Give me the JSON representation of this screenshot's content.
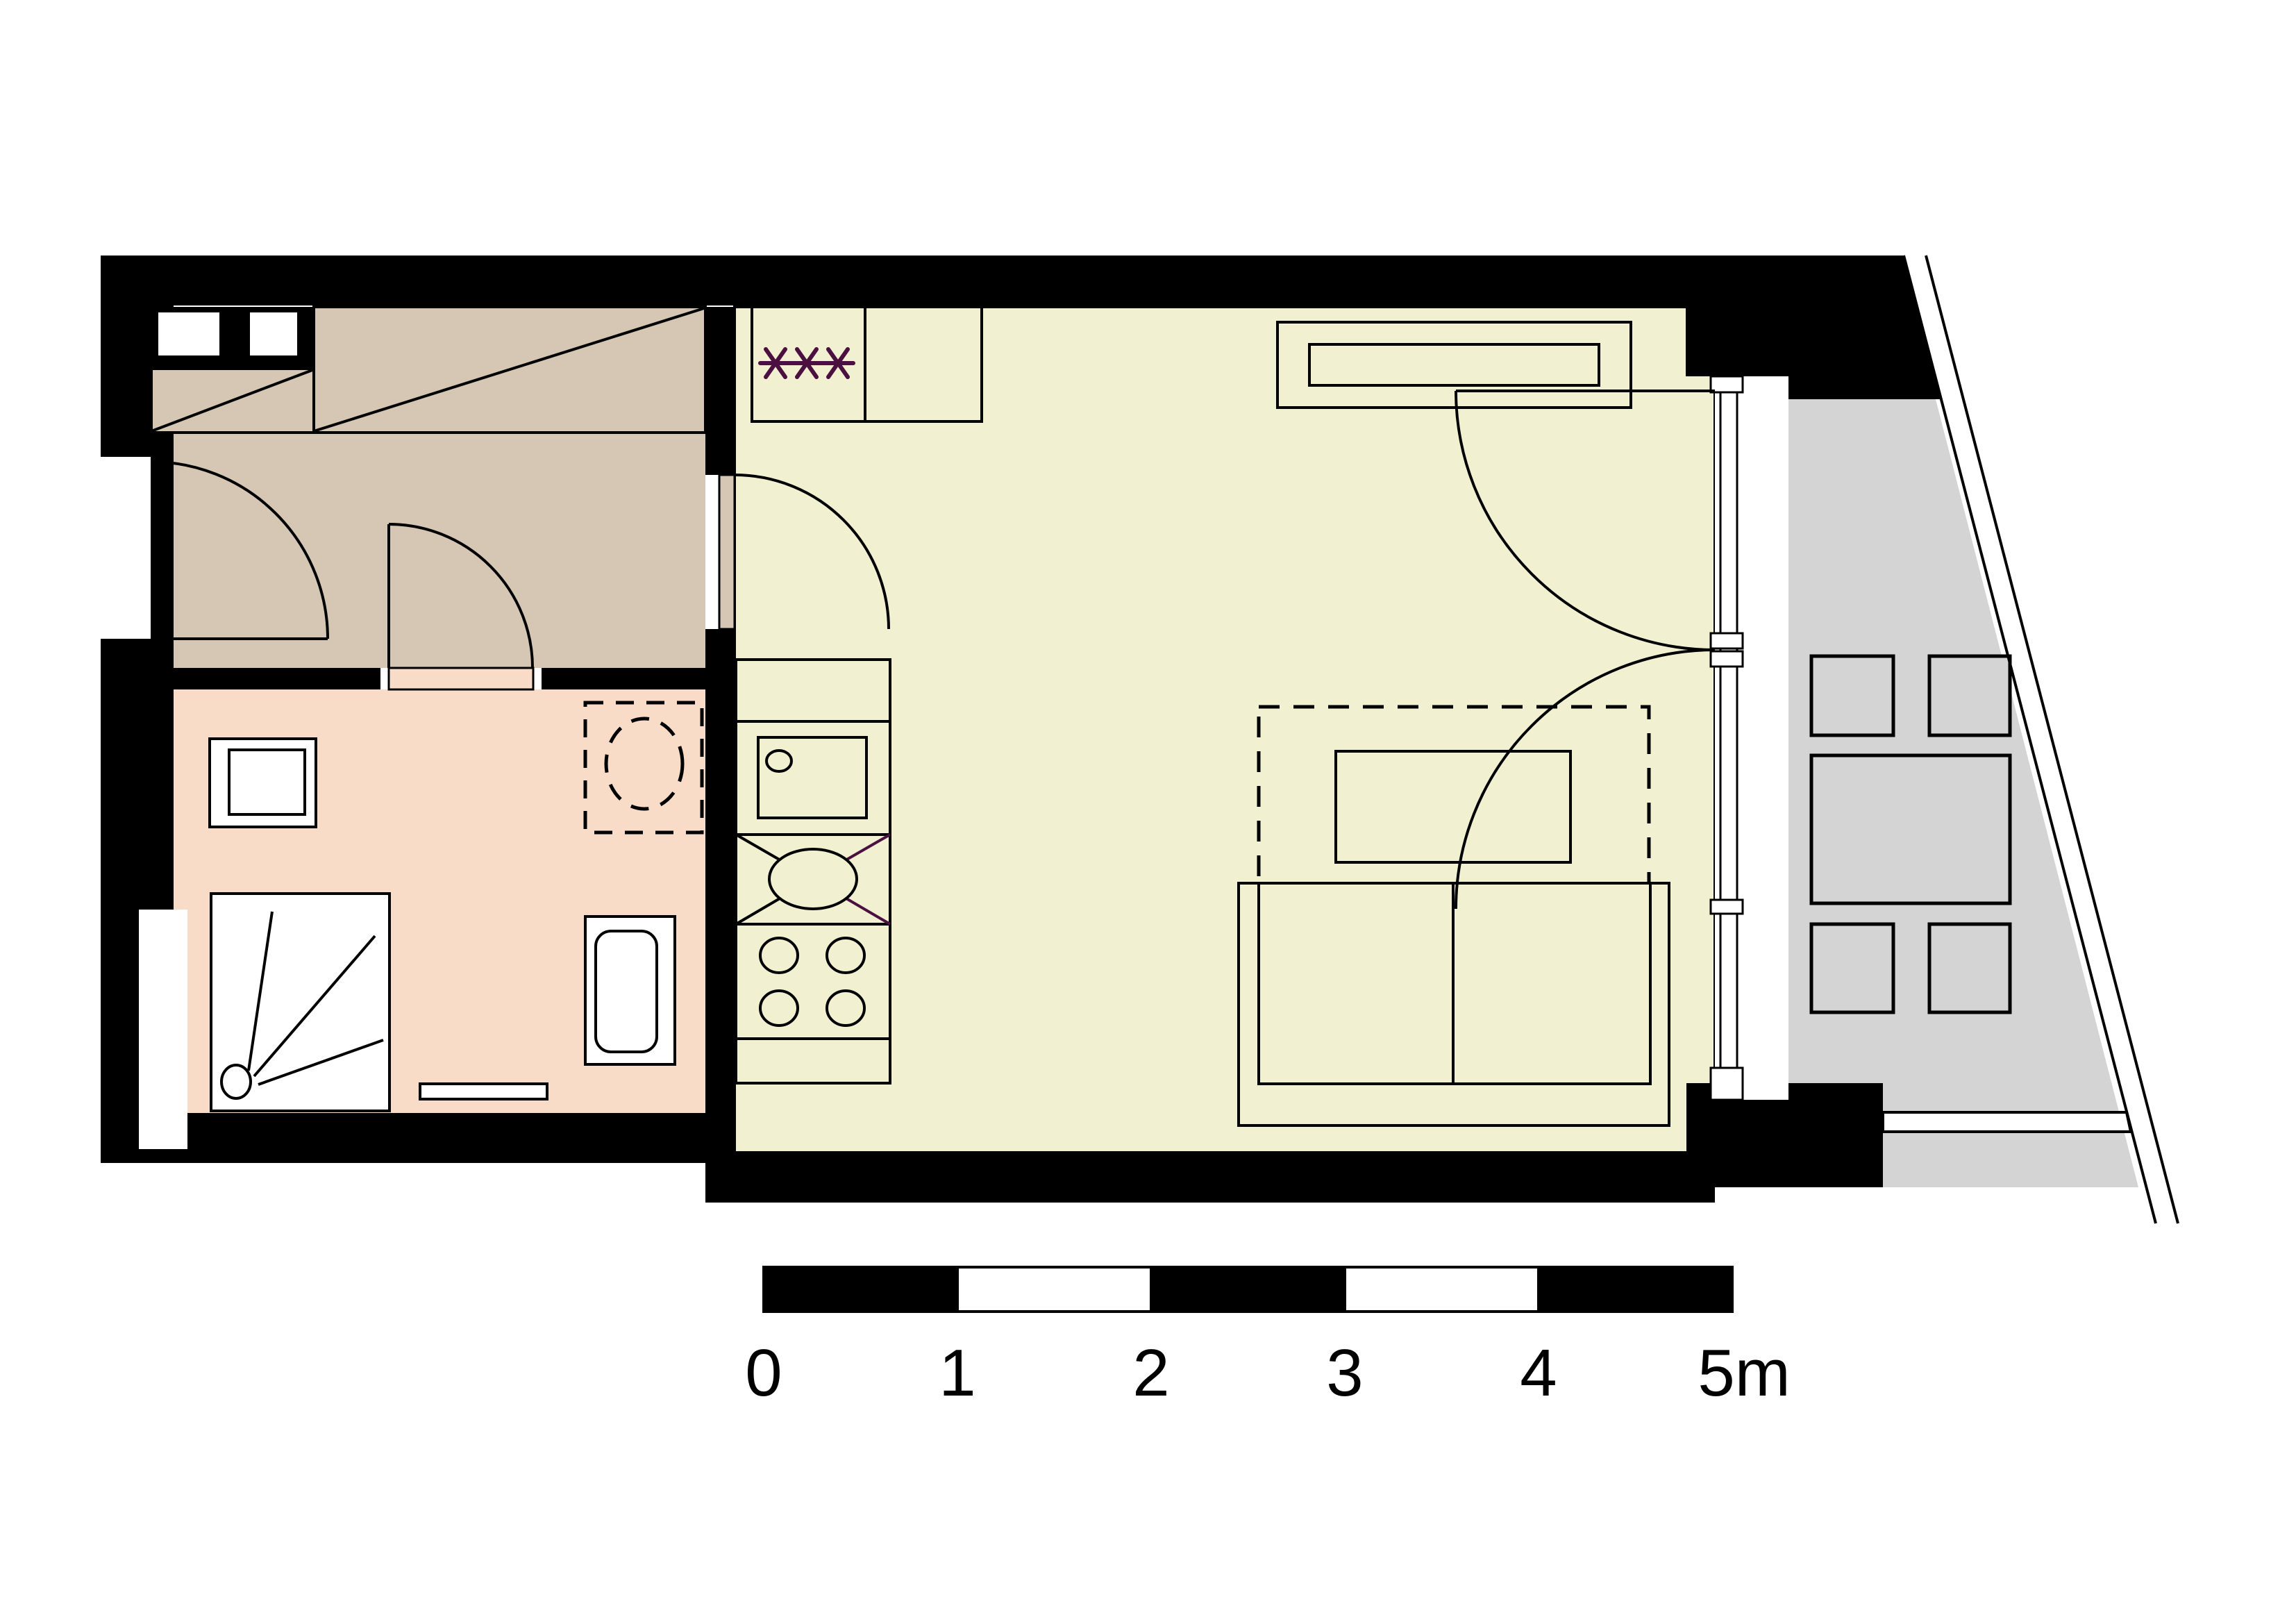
{
  "colors": {
    "background": "#ffffff",
    "wall": "#000000",
    "line": "#000000",
    "hall_floor": "#d6c6b4",
    "bathroom_floor": "#f9dcc8",
    "living_floor": "#f1f1d2",
    "balcony_floor": "#d4d4d4",
    "fixture_fill": "#ffffff",
    "accent_purple": "#4b1040"
  },
  "scale_bar": {
    "labels": [
      "0",
      "1",
      "2",
      "3",
      "4",
      "5m"
    ],
    "segments": [
      "#000000",
      "#ffffff",
      "#000000",
      "#ffffff",
      "#000000"
    ]
  },
  "symbols": {
    "kitchen_asterisk_count": 3,
    "stove_burner_count": 4,
    "balcony_chair_count": 4,
    "wall_shaft_count": 2
  }
}
